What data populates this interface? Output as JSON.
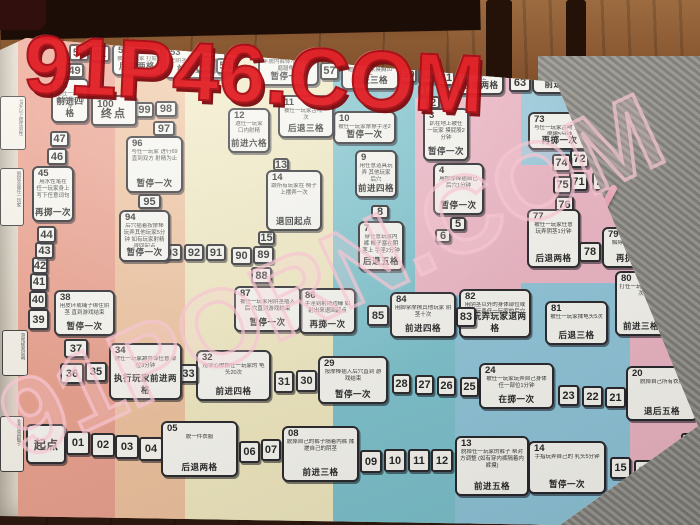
{
  "watermarks": {
    "top": "91P46.COM",
    "middle": "91PORN.COM"
  },
  "board": {
    "start_label": "起点",
    "end_label": "终点",
    "edge_bits": [
      {
        "t": "18岁以上成年男性",
        "x": 0,
        "y": 96,
        "w": 22,
        "h": 48
      },
      {
        "t": "脱掉衣服任一玩家",
        "x": 0,
        "y": 168,
        "w": 20,
        "h": 52
      },
      {
        "t": "游戏规则说明",
        "x": 2,
        "y": 330,
        "w": 22,
        "h": 40
      },
      {
        "t": "准备道具骰子",
        "x": 0,
        "y": 416,
        "w": 20,
        "h": 50
      }
    ],
    "cells": [
      {
        "n": "起点",
        "type": "start",
        "x": 26,
        "y": 424,
        "w": 40,
        "h": 40
      },
      {
        "n": "01",
        "type": "s",
        "x": 66,
        "y": 431,
        "w": 24,
        "h": 24
      },
      {
        "n": "02",
        "type": "s",
        "x": 91,
        "y": 433,
        "w": 24,
        "h": 24
      },
      {
        "n": "03",
        "type": "s",
        "x": 115,
        "y": 435,
        "w": 24,
        "h": 24
      },
      {
        "n": "04",
        "type": "s",
        "x": 139,
        "y": 437,
        "w": 24,
        "h": 24
      },
      {
        "n": "05",
        "type": "c",
        "x": 161,
        "y": 421,
        "w": 77,
        "h": 56,
        "d": "脱一件衣服",
        "a": "后退两格"
      },
      {
        "n": "06",
        "type": "s",
        "x": 239,
        "y": 441,
        "w": 21,
        "h": 22
      },
      {
        "n": "07",
        "type": "s",
        "x": 261,
        "y": 439,
        "w": 20,
        "h": 22
      },
      {
        "n": "08",
        "type": "c",
        "x": 282,
        "y": 426,
        "w": 77,
        "h": 56,
        "d": "脱掉自己的裤子隔着内裤 揉搓自己的阴茎",
        "a": "前进三格"
      },
      {
        "n": "09",
        "type": "s",
        "x": 360,
        "y": 450,
        "w": 22,
        "h": 23
      },
      {
        "n": "10",
        "type": "s",
        "x": 384,
        "y": 449,
        "w": 22,
        "h": 23
      },
      {
        "n": "11",
        "type": "s",
        "x": 408,
        "y": 449,
        "w": 22,
        "h": 23
      },
      {
        "n": "12",
        "type": "s",
        "x": 431,
        "y": 449,
        "w": 22,
        "h": 23
      },
      {
        "n": "13",
        "type": "c",
        "x": 455,
        "y": 436,
        "w": 74,
        "h": 60,
        "d": "脱掉任一玩家的裤子 帮对方调整 (如有穿内裤隔着内裤摸)",
        "a": "前进五格"
      },
      {
        "n": "14",
        "type": "c",
        "x": 528,
        "y": 441,
        "w": 78,
        "h": 53,
        "d": "手指玩弄自己的 乳头5分钟",
        "a": "暂停一次"
      },
      {
        "n": "15",
        "type": "s",
        "x": 610,
        "y": 457,
        "w": 21,
        "h": 22
      },
      {
        "n": "16",
        "type": "s",
        "x": 634,
        "y": 460,
        "w": 21,
        "h": 22
      },
      {
        "n": "17",
        "type": "s",
        "x": 657,
        "y": 462,
        "w": 21,
        "h": 22
      },
      {
        "n": "18",
        "type": "s",
        "x": 681,
        "y": 465,
        "w": 19,
        "h": 22
      },
      {
        "n": "19",
        "type": "s",
        "x": 681,
        "y": 433,
        "w": 20,
        "h": 21
      },
      {
        "n": "20",
        "type": "c",
        "x": 626,
        "y": 366,
        "w": 72,
        "h": 55,
        "d": "脱掉自己所有衣服",
        "a": "退后五格"
      },
      {
        "n": "21",
        "type": "s",
        "x": 605,
        "y": 387,
        "w": 21,
        "h": 21
      },
      {
        "n": "22",
        "type": "s",
        "x": 582,
        "y": 386,
        "w": 21,
        "h": 21
      },
      {
        "n": "23",
        "type": "s",
        "x": 558,
        "y": 385,
        "w": 21,
        "h": 21
      },
      {
        "n": "24",
        "type": "c",
        "x": 479,
        "y": 363,
        "w": 75,
        "h": 46,
        "d": "被任一玩家玩弄自己身体 任一部位1分钟",
        "a": "在掷一次"
      },
      {
        "n": "25",
        "type": "s",
        "x": 460,
        "y": 377,
        "w": 19,
        "h": 20
      },
      {
        "n": "26",
        "type": "s",
        "x": 437,
        "y": 376,
        "w": 19,
        "h": 20
      },
      {
        "n": "27",
        "type": "s",
        "x": 415,
        "y": 375,
        "w": 19,
        "h": 20
      },
      {
        "n": "28",
        "type": "s",
        "x": 392,
        "y": 374,
        "w": 19,
        "h": 20
      },
      {
        "n": "29",
        "type": "c",
        "x": 318,
        "y": 356,
        "w": 70,
        "h": 48,
        "d": "按摩棒插入后穴直到 游戏结束",
        "a": "暂停一次"
      },
      {
        "n": "30",
        "type": "s",
        "x": 296,
        "y": 370,
        "w": 21,
        "h": 22
      },
      {
        "n": "31",
        "type": "s",
        "x": 274,
        "y": 371,
        "w": 20,
        "h": 22
      },
      {
        "n": "32",
        "type": "c",
        "x": 196,
        "y": 350,
        "w": 75,
        "h": 51,
        "d": "用掌心摩擦任一玩家的 龟头20次",
        "a": "前进四格"
      },
      {
        "n": "33",
        "type": "s",
        "x": 179,
        "y": 364,
        "w": 19,
        "h": 19
      },
      {
        "n": "34",
        "type": "c",
        "x": 109,
        "y": 343,
        "w": 73,
        "h": 57,
        "d": "被任一玩家舔身体任意 部位3分钟",
        "a": "执行玩家前进两格"
      },
      {
        "n": "35",
        "type": "s",
        "x": 85,
        "y": 362,
        "w": 22,
        "h": 20
      },
      {
        "n": "36",
        "type": "s",
        "x": 60,
        "y": 363,
        "w": 24,
        "h": 21
      },
      {
        "n": "37",
        "type": "s",
        "x": 64,
        "y": 339,
        "w": 24,
        "h": 19
      },
      {
        "n": "38",
        "type": "c",
        "x": 54,
        "y": 290,
        "w": 61,
        "h": 46,
        "d": "用皮环或绳子绑住阴茎 直到游戏结束",
        "a": "暂停一次"
      },
      {
        "n": "39",
        "type": "s",
        "x": 28,
        "y": 309,
        "w": 21,
        "h": 21
      },
      {
        "n": "40",
        "type": "s",
        "x": 29,
        "y": 291,
        "w": 18,
        "h": 18
      },
      {
        "n": "41",
        "type": "s",
        "x": 30,
        "y": 273,
        "w": 18,
        "h": 18
      },
      {
        "n": "42",
        "type": "s",
        "x": 32,
        "y": 257,
        "w": 16,
        "h": 17
      },
      {
        "n": "43",
        "type": "s",
        "x": 35,
        "y": 242,
        "w": 19,
        "h": 17
      },
      {
        "n": "44",
        "type": "s",
        "x": 37,
        "y": 226,
        "w": 19,
        "h": 17
      },
      {
        "n": "45",
        "type": "c",
        "x": 32,
        "y": 166,
        "w": 42,
        "h": 56,
        "d": "用水性笔在 任一玩家身上 写下任意词句",
        "a": "再掷一次"
      },
      {
        "n": "46",
        "type": "s",
        "x": 47,
        "y": 148,
        "w": 20,
        "h": 17
      },
      {
        "n": "47",
        "type": "s",
        "x": 50,
        "y": 131,
        "w": 19,
        "h": 16
      },
      {
        "n": "48",
        "type": "c",
        "x": 51,
        "y": 78,
        "w": 38,
        "h": 45,
        "d": "邀任一玩家 揉搓龟头10次",
        "a": "前进四格"
      },
      {
        "n": "49",
        "type": "s",
        "x": 65,
        "y": 63,
        "w": 19,
        "h": 15
      },
      {
        "n": "50",
        "type": "s",
        "x": 69,
        "y": 44,
        "w": 20,
        "h": 17
      },
      {
        "n": "51",
        "type": "s",
        "x": 90,
        "y": 45,
        "w": 20,
        "h": 17
      },
      {
        "n": "52",
        "type": "c",
        "x": 112,
        "y": 43,
        "w": 50,
        "h": 33,
        "d": "被任一玩家 打屁股10次",
        "a": "后退两格"
      },
      {
        "n": "53",
        "type": "c",
        "x": 164,
        "y": 45,
        "w": 62,
        "h": 34,
        "d": "把阴茎塞入任一玩家的 屁股或口中",
        "a": "前进五格"
      },
      {
        "n": "54",
        "type": "s",
        "x": 196,
        "y": 56,
        "w": 19,
        "h": 16
      },
      {
        "n": "55",
        "type": "s",
        "x": 216,
        "y": 58,
        "w": 19,
        "h": 16
      },
      {
        "n": "56",
        "type": "c",
        "x": 258,
        "y": 46,
        "w": 61,
        "h": 40,
        "d": "半脱内裤体不脱 互相磨蹭龟头",
        "a": "暂停一次"
      },
      {
        "n": "57",
        "type": "s",
        "x": 320,
        "y": 62,
        "w": 19,
        "h": 18
      },
      {
        "n": "58",
        "type": "c",
        "x": 341,
        "y": 54,
        "w": 58,
        "h": 36,
        "d": "邀任一玩家摸胸10次",
        "a": "前进三格"
      },
      {
        "n": "59",
        "type": "s",
        "x": 400,
        "y": 67,
        "w": 17,
        "h": 16
      },
      {
        "n": "60",
        "type": "s",
        "x": 418,
        "y": 68,
        "w": 17,
        "h": 16
      },
      {
        "n": "61",
        "type": "s",
        "x": 437,
        "y": 70,
        "w": 18,
        "h": 16
      },
      {
        "n": "62",
        "type": "c",
        "x": 457,
        "y": 59,
        "w": 47,
        "h": 36,
        "d": "弹任一玩家蛋蛋20次",
        "a": "后退两格"
      },
      {
        "n": "63",
        "type": "s",
        "x": 509,
        "y": 73,
        "w": 22,
        "h": 19
      },
      {
        "n": "64",
        "type": "c",
        "x": 532,
        "y": 61,
        "w": 61,
        "h": 33,
        "d": "用皮鞭打任一玩家 屁股10次",
        "a": "前进六格"
      },
      {
        "n": "65",
        "type": "s",
        "x": 597,
        "y": 69,
        "w": 19,
        "h": 17
      },
      {
        "n": "66",
        "type": "s",
        "x": 617,
        "y": 71,
        "w": 19,
        "h": 17
      },
      {
        "n": "67",
        "type": "s",
        "x": 622,
        "y": 89,
        "w": 19,
        "h": 17
      },
      {
        "n": "68",
        "type": "c",
        "x": 606,
        "y": 99,
        "w": 49,
        "h": 53,
        "d": "趴在地上摩擦 阴茎10次",
        "a": "暂停一次"
      },
      {
        "n": "69",
        "type": "c",
        "x": 609,
        "y": 154,
        "w": 50,
        "h": 57,
        "d": "用脚掌摩擦任一 玩家奶头15次",
        "a": "后退四格"
      },
      {
        "n": "70",
        "type": "s",
        "x": 592,
        "y": 172,
        "w": 19,
        "h": 19
      },
      {
        "n": "71",
        "type": "s",
        "x": 569,
        "y": 172,
        "w": 19,
        "h": 19
      },
      {
        "n": "72",
        "type": "s",
        "x": 570,
        "y": 149,
        "w": 19,
        "h": 19
      },
      {
        "n": "73",
        "type": "c",
        "x": 528,
        "y": 112,
        "w": 63,
        "h": 38,
        "d": "与任一玩家舌吻 互相摩擦5分钟",
        "a": "再掷一次"
      },
      {
        "n": "74",
        "type": "s",
        "x": 552,
        "y": 154,
        "w": 19,
        "h": 18
      },
      {
        "n": "75",
        "type": "s",
        "x": 553,
        "y": 176,
        "w": 19,
        "h": 18
      },
      {
        "n": "76",
        "type": "s",
        "x": 555,
        "y": 196,
        "w": 19,
        "h": 18
      },
      {
        "n": "77",
        "type": "c",
        "x": 527,
        "y": 209,
        "w": 53,
        "h": 59,
        "d": "被任一玩家任意 玩弄阴茎1分钟",
        "a": "后退两格"
      },
      {
        "n": "78",
        "type": "s",
        "x": 579,
        "y": 242,
        "w": 22,
        "h": 20
      },
      {
        "n": "79",
        "type": "c",
        "x": 602,
        "y": 227,
        "w": 64,
        "h": 41,
        "d": "解除身上所有道具",
        "a": "再掷一次"
      },
      {
        "n": "80",
        "type": "c",
        "x": 615,
        "y": 271,
        "w": 52,
        "h": 65,
        "d": "打任一玩家 屁股5次",
        "a": "前进三格"
      },
      {
        "n": "81",
        "type": "c",
        "x": 545,
        "y": 301,
        "w": 63,
        "h": 44,
        "d": "被任一玩家揉龟头5次",
        "a": "后退三格"
      },
      {
        "n": "82",
        "type": "c",
        "x": 459,
        "y": 289,
        "w": 72,
        "h": 49,
        "d": "用阴茎以外的身体部位或 道具玩弄任一玩家的后穴",
        "a": "被玩弄玩家退两格"
      },
      {
        "n": "83",
        "type": "s",
        "x": 456,
        "y": 307,
        "w": 20,
        "h": 20
      },
      {
        "n": "84",
        "type": "c",
        "x": 390,
        "y": 292,
        "w": 66,
        "h": 46,
        "d": "用脚掌摩擦其他玩家 阴茎十次",
        "a": "前进四格"
      },
      {
        "n": "85",
        "type": "s",
        "x": 367,
        "y": 305,
        "w": 22,
        "h": 21
      },
      {
        "n": "86",
        "type": "c",
        "x": 299,
        "y": 288,
        "w": 57,
        "h": 46,
        "d": "手淫到射精边缘 如射出来退回起点",
        "a": "再掷一次"
      },
      {
        "n": "87",
        "type": "c",
        "x": 234,
        "y": 286,
        "w": 67,
        "h": 46,
        "d": "被任一玩家用阴茎插入后 穴直到游戏结束",
        "a": "暂停一次"
      },
      {
        "n": "88",
        "type": "s",
        "x": 251,
        "y": 267,
        "w": 21,
        "h": 17
      },
      {
        "n": "89",
        "type": "s",
        "x": 253,
        "y": 246,
        "w": 21,
        "h": 18
      },
      {
        "n": "90",
        "type": "s",
        "x": 231,
        "y": 247,
        "w": 21,
        "h": 18
      },
      {
        "n": "91",
        "type": "s",
        "x": 206,
        "y": 244,
        "w": 20,
        "h": 17
      },
      {
        "n": "92",
        "type": "s",
        "x": 184,
        "y": 244,
        "w": 20,
        "h": 17
      },
      {
        "n": "93",
        "type": "s",
        "x": 162,
        "y": 244,
        "w": 20,
        "h": 17
      },
      {
        "n": "94",
        "type": "c",
        "x": 119,
        "y": 210,
        "w": 51,
        "h": 52,
        "d": "后穴插着按摩棒 玩弄其他玩家5分钟 如有玩家射精退回起点",
        "a": "暂停一次"
      },
      {
        "n": "95",
        "type": "s",
        "x": 138,
        "y": 194,
        "w": 23,
        "h": 15
      },
      {
        "n": "96",
        "type": "c",
        "x": 126,
        "y": 136,
        "w": 57,
        "h": 57,
        "d": "与任一玩家 进行69 直到双方 射精为止",
        "a": "暂停一次"
      },
      {
        "n": "97",
        "type": "s",
        "x": 153,
        "y": 121,
        "w": 22,
        "h": 15
      },
      {
        "n": "98",
        "type": "s",
        "x": 155,
        "y": 101,
        "w": 22,
        "h": 16
      },
      {
        "n": "99",
        "type": "s",
        "x": 135,
        "y": 102,
        "w": 19,
        "h": 16
      },
      {
        "n": "100",
        "type": "end",
        "x": 91,
        "y": 95,
        "w": 46,
        "h": 31
      },
      {
        "n": "1",
        "type": "s",
        "x": 418,
        "y": 84,
        "w": 14,
        "h": 13
      },
      {
        "n": "2",
        "type": "s",
        "x": 426,
        "y": 96,
        "w": 14,
        "h": 13
      },
      {
        "n": "3",
        "type": "c",
        "x": 423,
        "y": 108,
        "w": 46,
        "h": 53,
        "d": "趴在地上被任一玩家 摸屁股2分钟",
        "a": "暂停一次"
      },
      {
        "n": "4",
        "type": "c",
        "x": 433,
        "y": 163,
        "w": 51,
        "h": 52,
        "d": "用按摩棒插自己 后穴1分钟",
        "a": "暂停一次"
      },
      {
        "n": "5",
        "type": "s",
        "x": 450,
        "y": 217,
        "w": 16,
        "h": 14
      },
      {
        "n": "6",
        "type": "s",
        "x": 435,
        "y": 229,
        "w": 16,
        "h": 14
      },
      {
        "n": "7",
        "type": "c",
        "x": 358,
        "y": 221,
        "w": 46,
        "h": 50,
        "d": "穿任意玩家内裤 棒子塞在阴茎上 手淫2分钟",
        "a": "后退五格"
      },
      {
        "n": "8",
        "type": "s",
        "x": 371,
        "y": 205,
        "w": 18,
        "h": 14
      },
      {
        "n": "9",
        "type": "c",
        "x": 355,
        "y": 150,
        "w": 42,
        "h": 48,
        "d": "用任意道具玩弄 其他玩家后穴",
        "a": "前进四格"
      },
      {
        "n": "10",
        "type": "c",
        "x": 333,
        "y": 111,
        "w": 63,
        "h": 33,
        "d": "被任一玩家摩擦手淫2分钟",
        "a": "暂停一次"
      },
      {
        "n": "11",
        "type": "c",
        "x": 278,
        "y": 95,
        "w": 56,
        "h": 43,
        "d": "被任一玩家舌吻一次",
        "a": "后退三格"
      },
      {
        "n": "12",
        "type": "c",
        "x": 228,
        "y": 108,
        "w": 42,
        "h": 45,
        "d": "邀任一玩家 口内射精",
        "a": "前进六格"
      },
      {
        "n": "13",
        "type": "s",
        "x": 273,
        "y": 158,
        "w": 16,
        "h": 13
      },
      {
        "n": "14",
        "type": "c",
        "x": 266,
        "y": 170,
        "w": 56,
        "h": 61,
        "d": "跟所有玩家在 椅子上摆弄一次",
        "a": "退回起点"
      },
      {
        "n": "15",
        "type": "s",
        "x": 258,
        "y": 231,
        "w": 17,
        "h": 14
      }
    ]
  }
}
